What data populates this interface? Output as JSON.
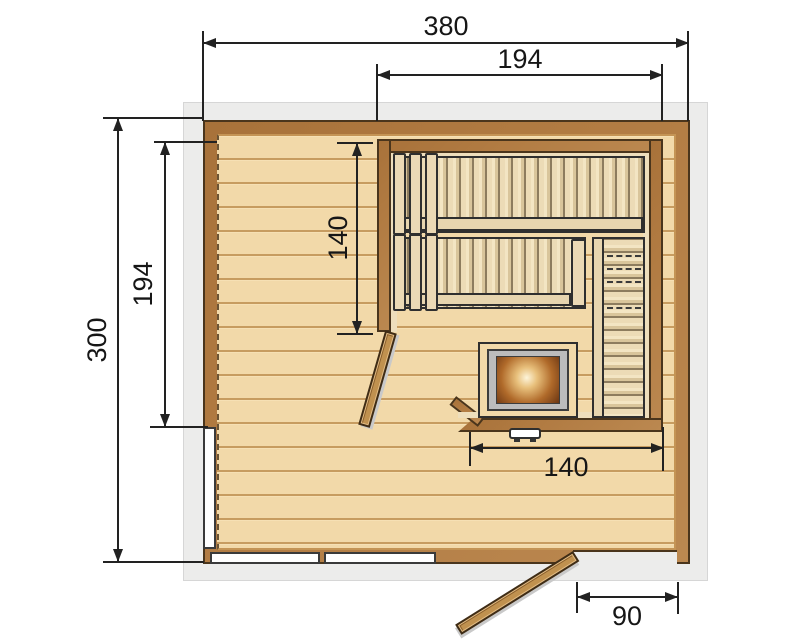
{
  "dimensions": {
    "overall_width": "380",
    "top_inner_width": "194",
    "overall_depth": "300",
    "left_inner_depth": "194",
    "cabin_inner_depth": "140",
    "cabin_inner_width": "140",
    "door_width": "90"
  },
  "colors": {
    "wall": "#b17b42",
    "wall-dark": "#4a351c",
    "floor": "#f2d9a9",
    "floor-line": "#c79c60",
    "bench": "#ecdbb6",
    "bench-dark": "#2f2f2f",
    "surround": "#ececeb",
    "dim": "#222222",
    "window": "#ffffff",
    "door": "#c0914f",
    "heater-frame": "#bcbcbc"
  }
}
